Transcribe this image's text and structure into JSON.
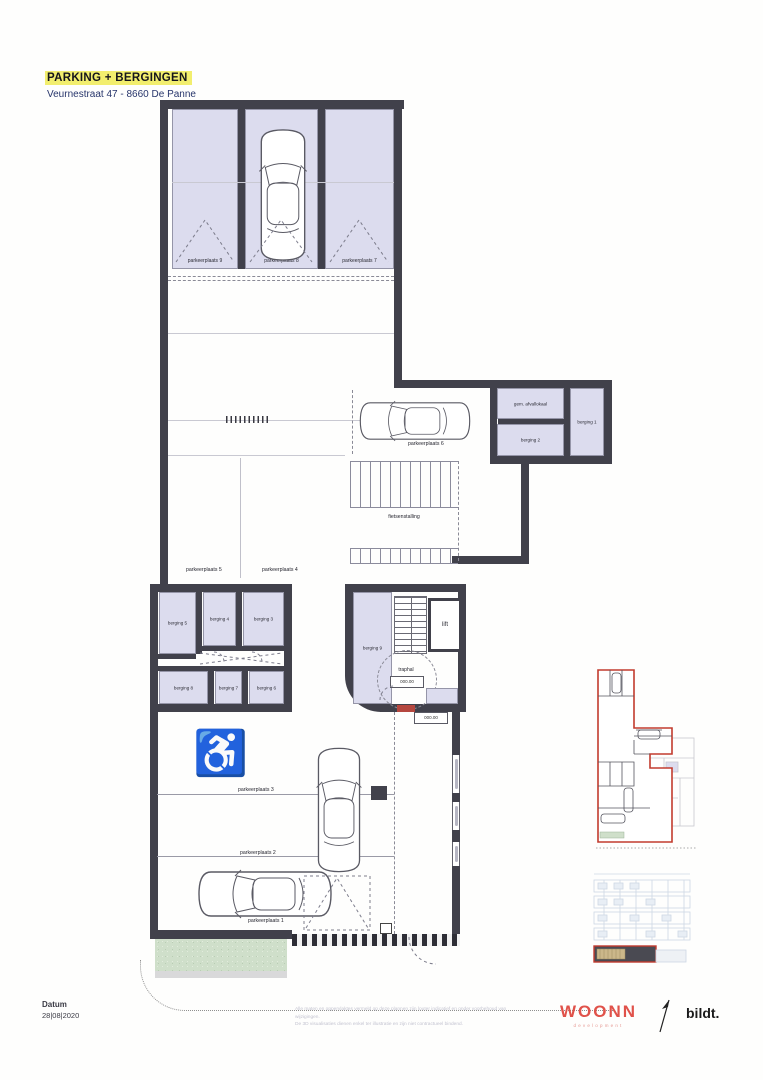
{
  "document": {
    "title": "PARKING + BERGINGEN",
    "subtitle": "Veurnestraat 47 - 8660 De Panne",
    "date_label": "Datum",
    "date_value": "28|08|2020",
    "disclaimer_line1": "Alle maten en oppervlaktes vermeld op deze plannen zijn louter indicatief en onder voorbehoud van wijzigingen.",
    "disclaimer_line2": "De 3D visualisaties dienen enkel ter illustratie en zijn niet contractueel bindend.",
    "brand_primary": "WOONN",
    "brand_primary_sub": "development",
    "brand_secondary": "bildt."
  },
  "plan": {
    "parking_spaces": {
      "p1": "parkeerplaats 1",
      "p2": "parkeerplaats 2",
      "p3": "parkeerplaats 3",
      "p4": "parkeerplaats 4",
      "p5": "parkeerplaats 5",
      "p6": "parkeerplaats 6",
      "p7": "parkeerplaats 7",
      "p8": "parkeerplaats 8",
      "p9": "parkeerplaats 9"
    },
    "rooms": {
      "b1": "berging 1",
      "b2": "berging 2",
      "b3": "berging 3",
      "b4": "berging 4",
      "b5": "berging 5",
      "b6": "berging 6",
      "b7": "berging 7",
      "b8": "berging 8",
      "b9": "berging 9",
      "afval": "gem. afvallokaal",
      "fietsenstalling": "fietsenstalling",
      "lift": "lift",
      "traphal": "traphal"
    },
    "levels": {
      "ground": "000.00"
    },
    "icons": {
      "wheelchair": "♿"
    }
  },
  "colors": {
    "wall": "#41414b",
    "room_fill": "#dcdcee",
    "title_highlight": "#f2ee6e",
    "subtitle_navy": "#27356b",
    "accent_red": "#e0524a",
    "keyplan_red": "#c23b2e",
    "wheelchair_blue": "#b9c4dd",
    "garden_green": "#cfdfca"
  }
}
